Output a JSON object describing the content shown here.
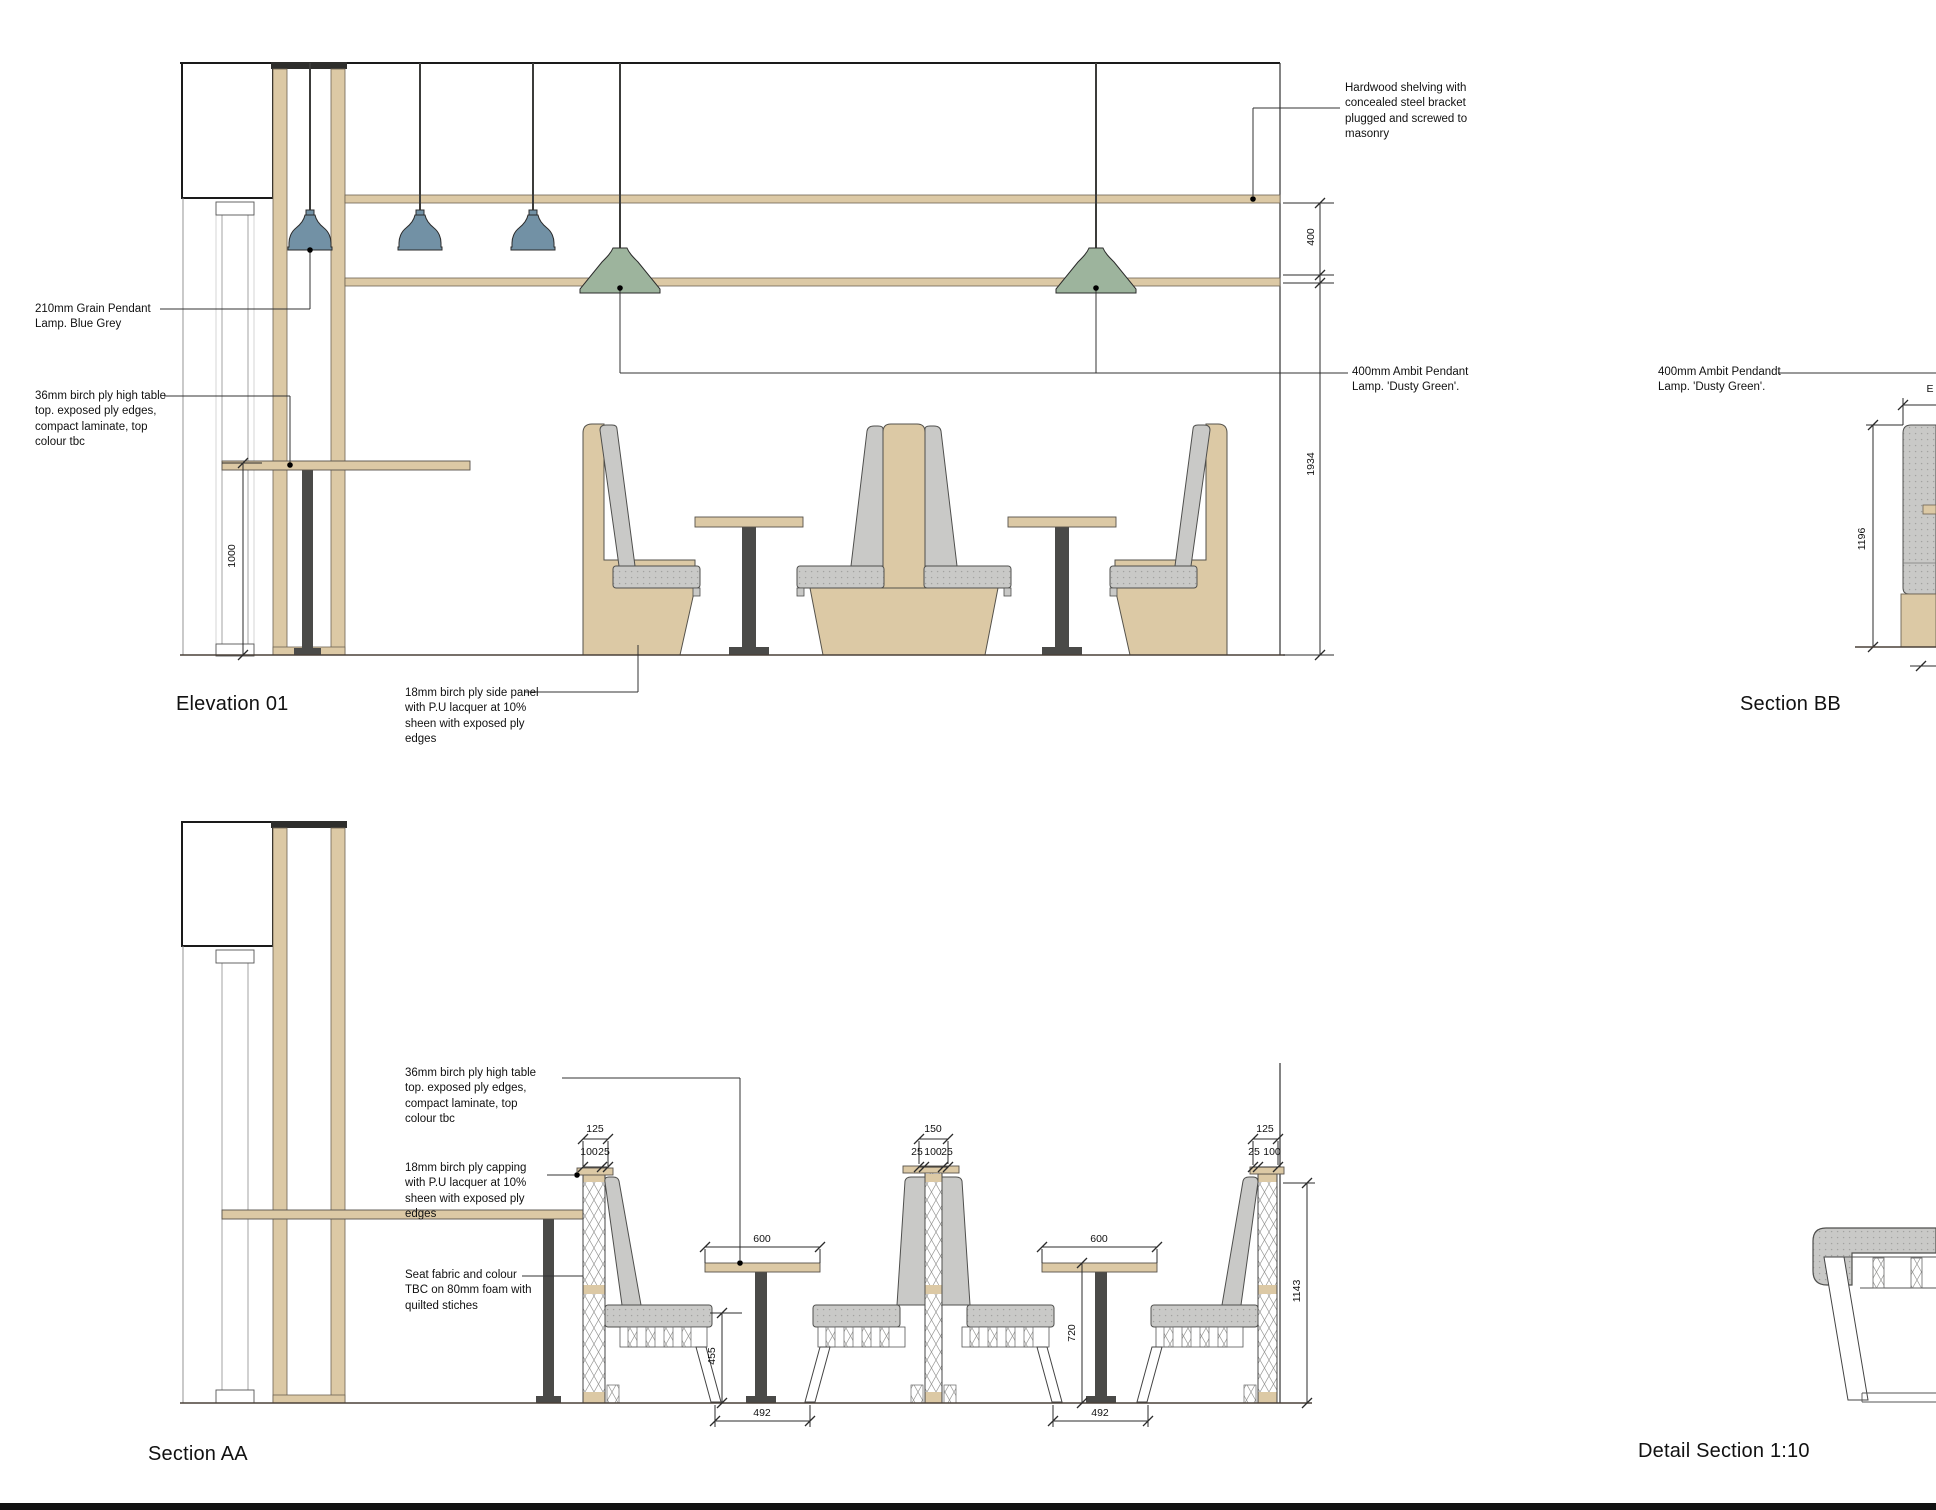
{
  "titles": {
    "elevation01": "Elevation 01",
    "sectionBB": "Section BB",
    "sectionAA": "Section AA",
    "detailSection": "Detail Section 1:10"
  },
  "elevation01": {
    "annotations": {
      "grainPendant": "210mm Grain Pendant\nLamp. Blue Grey",
      "highTable": "36mm birch ply high table\ntop. exposed ply edges,\ncompact laminate, top\ncolour tbc",
      "sidePanel": "18mm birch ply side panel\nwith P.U lacquer at 10%\nsheen with exposed ply\nedges",
      "shelving": "Hardwood shelving with\nconcealed steel bracket\nplugged and screwed to\nmasonry",
      "ambitPendant": "400mm Ambit Pendant\nLamp. 'Dusty Green'."
    },
    "dims": {
      "shelfGap": "400",
      "lowerHeight": "1934",
      "tableHeight": "1000"
    }
  },
  "sectionBB": {
    "annotations": {
      "ambitPendant": "400mm Ambit Pendandt\nLamp. 'Dusty Green'."
    },
    "dims": {
      "height": "1196",
      "widthLabel": "E"
    }
  },
  "sectionAA": {
    "annotations": {
      "highTable": "36mm birch ply high table\ntop. exposed ply edges,\ncompact laminate, top\ncolour tbc",
      "capping": "18mm birch ply capping\nwith P.U lacquer at 10%\nsheen with exposed ply\nedges",
      "seatFabric": "Seat fabric and colour\nTBC on 80mm foam with\nquilted stiches"
    },
    "dims": {
      "booth1": {
        "top": "125",
        "layers": [
          "100",
          "25"
        ]
      },
      "booth2": {
        "top": "150",
        "layers": [
          "25",
          "100",
          "25"
        ]
      },
      "booth3": {
        "top": "125",
        "layers": [
          "25",
          "100"
        ]
      },
      "table1Width": "600",
      "table2Width": "600",
      "seatHeight": "455",
      "tableHeight": "720",
      "table1Base": "492",
      "table2Base": "492",
      "boothHeight": "1143"
    }
  },
  "colors": {
    "birchPly": "#dcc9a5",
    "upholsteryGrey": "#c9c9c7",
    "lampBlueGrey": "#7291a5",
    "lampDustyGreen": "#9db49d",
    "steelDark": "#4a4a48",
    "lineDark": "#2b2b2b"
  }
}
